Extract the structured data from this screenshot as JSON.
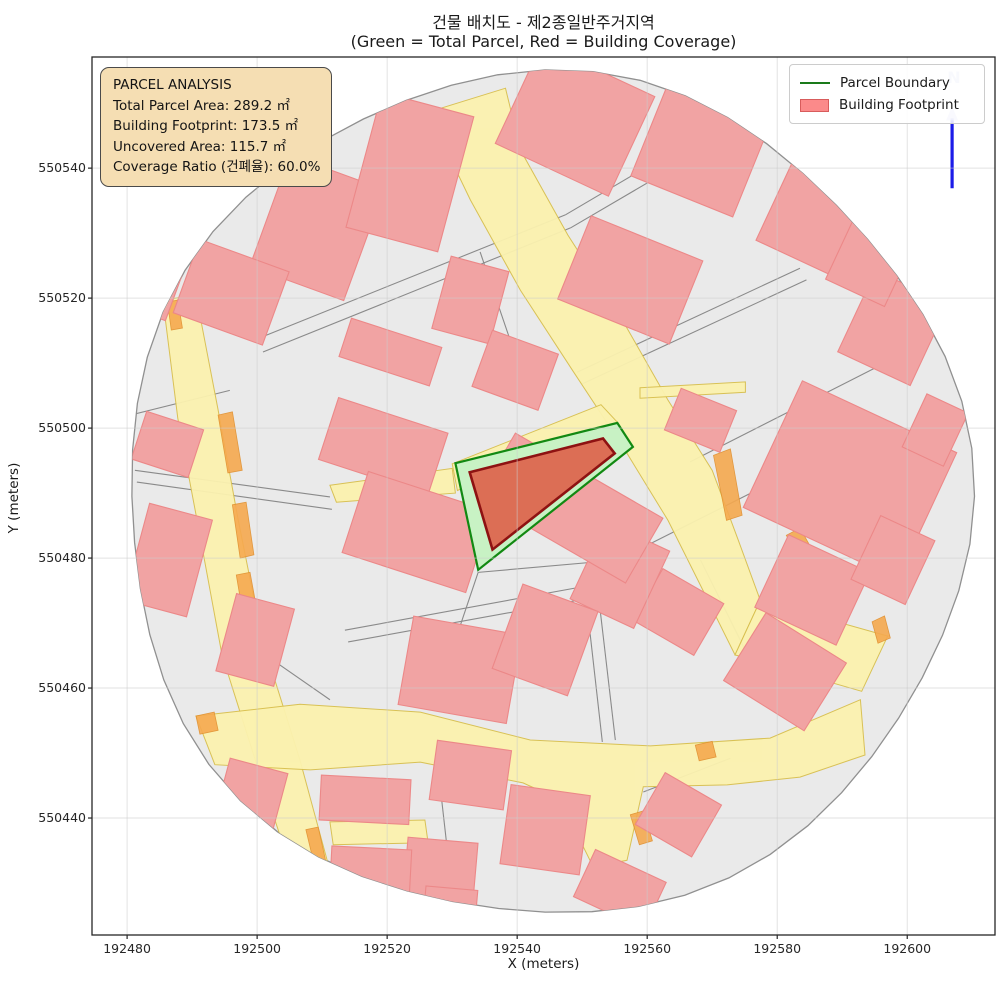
{
  "figure": {
    "title": "건물 배치도 - 제2종일반주거지역",
    "subtitle": "(Green = Total Parcel, Red = Building Coverage)"
  },
  "axes": {
    "xlabel": "X (meters)",
    "ylabel": "Y (meters)",
    "xticks": [
      192480,
      192500,
      192520,
      192540,
      192560,
      192580,
      192600
    ],
    "yticks": [
      550440,
      550460,
      550480,
      550500,
      550520,
      550540
    ],
    "xlim": [
      192474.6,
      192613.5
    ],
    "ylim": [
      550422.0,
      550557.1
    ],
    "grid": true
  },
  "info_box": {
    "lines": [
      "PARCEL ANALYSIS",
      "Total Parcel Area: 289.2 ㎡",
      "Building Footprint: 173.5 ㎡",
      "Uncovered Area: 115.7 ㎡",
      "Coverage Ratio (건폐율): 60.0%"
    ],
    "fill": "#f5deb3"
  },
  "legend": {
    "entries": [
      {
        "label": "Parcel Boundary",
        "type": "line",
        "color": "#1a7a1a"
      },
      {
        "label": "Building Footprint",
        "type": "patch",
        "fill": "#fb8a8a",
        "stroke": "#d85c5c"
      }
    ]
  },
  "north_arrow": {
    "label": "N",
    "shaft_color": "#1c1ce8",
    "head_color": "#b3b9ea",
    "x": 192606.9,
    "y_base": 550536.9,
    "y_tip": 550549.5
  },
  "colors": {
    "buffer_fill": "#eaeaea",
    "buffer_edge": "#909090",
    "road_fill": "#fbf2af",
    "road_edge": "#d8bf4e",
    "orange_fill": "#f5a94f",
    "orange_edge": "#e08f2e",
    "building_fill": "#f1a3a3",
    "building_edge": "#ec8888",
    "parcel_line": "#8a8a8a",
    "parcel_fill": "#c8f2c4",
    "parcel_edge": "#128912",
    "footprint_fill": "#dc6e55",
    "footprint_edge": "#8e1212",
    "grid": "#cccccc",
    "frame": "#262626"
  },
  "chart_data": {
    "type": "map",
    "title": "건물 배치도 - 제2종일반주거지역",
    "buffer": {
      "cx": 192544.3,
      "cy": 550489.5,
      "radius_m": 64.8
    },
    "highlight_parcel": {
      "name": "analysis parcel",
      "points": [
        [
          192530.5,
          550494.6
        ],
        [
          192555.4,
          550500.8
        ],
        [
          192557.8,
          550497.1
        ],
        [
          192534.0,
          550478.2
        ]
      ]
    },
    "highlight_building": {
      "name": "building footprint",
      "points": [
        [
          192532.7,
          550493.2
        ],
        [
          192553.2,
          550498.4
        ],
        [
          192555.0,
          550496.1
        ],
        [
          192536.2,
          550481.3
        ]
      ]
    },
    "roads": [
      [
        [
          192485.5,
          550519.7
        ],
        [
          192490.6,
          550520.5
        ],
        [
          192494.0,
          550502.8
        ],
        [
          192497.1,
          550485.8
        ],
        [
          192500.8,
          550467.4
        ],
        [
          192506.6,
          550448.9
        ],
        [
          192511.5,
          550430.8
        ],
        [
          192506.0,
          550429.8
        ],
        [
          192500.2,
          550447.4
        ],
        [
          192494.6,
          550465.1
        ],
        [
          192491.2,
          550483.5
        ],
        [
          192487.8,
          550501.5
        ]
      ],
      [
        [
          192526.3,
          550548.6
        ],
        [
          192532.8,
          550535.1
        ],
        [
          192540.5,
          550521.2
        ],
        [
          192548.5,
          550508.9
        ],
        [
          192556.6,
          550496.6
        ],
        [
          192563.2,
          550485.8
        ],
        [
          192568.2,
          550475.8
        ],
        [
          192573.5,
          550465.1
        ],
        [
          192577.4,
          550473.5
        ],
        [
          192574.0,
          550482.8
        ],
        [
          192570.0,
          550493.5
        ],
        [
          192563.2,
          550504.3
        ],
        [
          192556.2,
          550516.6
        ],
        [
          192547.8,
          550529.7
        ],
        [
          192540.5,
          550542.8
        ],
        [
          192538.2,
          550552.3
        ]
      ],
      [
        [
          192573.5,
          550465.1
        ],
        [
          192577.4,
          550473.5
        ],
        [
          192597.0,
          550468.0
        ],
        [
          192593.0,
          550459.5
        ]
      ],
      [
        [
          192490.6,
          550455.7
        ],
        [
          192506.6,
          550457.5
        ],
        [
          192525.1,
          550456.3
        ],
        [
          192542.0,
          550452.0
        ],
        [
          192560.5,
          550451.1
        ],
        [
          192578.9,
          550452.3
        ],
        [
          192592.8,
          550458.2
        ],
        [
          192593.5,
          550449.7
        ],
        [
          192583.5,
          550446.3
        ],
        [
          192572.3,
          550445.1
        ],
        [
          192559.4,
          550444.8
        ],
        [
          192556.9,
          550433.5
        ],
        [
          192551.7,
          550432.5
        ],
        [
          192546.6,
          550442.8
        ],
        [
          192540.9,
          550445.4
        ],
        [
          192525.1,
          550448.6
        ],
        [
          192508.2,
          550447.4
        ],
        [
          192493.5,
          550448.2
        ]
      ],
      [
        [
          192511.2,
          550491.2
        ],
        [
          192530.0,
          550493.8
        ],
        [
          192530.5,
          550490.0
        ],
        [
          192512.2,
          550488.6
        ]
      ],
      [
        [
          192530.0,
          550494.5
        ],
        [
          192552.9,
          550503.6
        ],
        [
          192555.4,
          550500.9
        ],
        [
          192530.8,
          550490.4
        ]
      ],
      [
        [
          192558.9,
          550506.2
        ],
        [
          192575.1,
          550507.1
        ],
        [
          192575.1,
          550505.5
        ],
        [
          192558.9,
          550504.6
        ]
      ],
      [
        [
          192511.2,
          550439.4
        ],
        [
          192525.8,
          550439.7
        ],
        [
          192526.3,
          550436.2
        ],
        [
          192511.7,
          550435.9
        ]
      ]
    ],
    "orange_zones": [
      [
        [
          192486.2,
          550519.4
        ],
        [
          192487.8,
          550519.7
        ],
        [
          192488.5,
          550515.4
        ],
        [
          192486.8,
          550515.1
        ]
      ],
      [
        [
          192494.0,
          550502.0
        ],
        [
          192496.2,
          550502.5
        ],
        [
          192497.7,
          550493.5
        ],
        [
          192495.5,
          550493.1
        ]
      ],
      [
        [
          192496.2,
          550488.2
        ],
        [
          192498.3,
          550488.6
        ],
        [
          192499.5,
          550480.5
        ],
        [
          192497.4,
          550480.0
        ]
      ],
      [
        [
          192496.8,
          550477.4
        ],
        [
          192498.9,
          550477.8
        ],
        [
          192500.2,
          550470.8
        ],
        [
          192498.0,
          550470.3
        ]
      ],
      [
        [
          192507.5,
          550438.2
        ],
        [
          192509.4,
          550438.6
        ],
        [
          192510.6,
          550433.2
        ],
        [
          192508.8,
          550432.8
        ]
      ],
      [
        [
          192570.2,
          550495.8
        ],
        [
          192572.8,
          550496.8
        ],
        [
          192574.6,
          550486.6
        ],
        [
          192572.2,
          550485.8
        ]
      ],
      [
        [
          192581.4,
          550483.5
        ],
        [
          192583.5,
          550484.6
        ],
        [
          192588.2,
          550476.3
        ],
        [
          192586.0,
          550475.4
        ]
      ],
      [
        [
          192594.6,
          550470.2
        ],
        [
          192596.5,
          550471.1
        ],
        [
          192597.4,
          550467.7
        ],
        [
          192595.5,
          550466.9
        ]
      ],
      [
        [
          192557.4,
          550440.5
        ],
        [
          192559.4,
          550441.1
        ],
        [
          192560.8,
          550436.5
        ],
        [
          192558.8,
          550435.9
        ]
      ],
      [
        [
          192567.4,
          550451.2
        ],
        [
          192570.0,
          550451.8
        ],
        [
          192570.6,
          550449.4
        ],
        [
          192568.0,
          550448.8
        ]
      ],
      [
        [
          192490.6,
          550455.7
        ],
        [
          192493.4,
          550456.3
        ],
        [
          192494.0,
          550453.5
        ],
        [
          192491.2,
          550452.9
        ]
      ]
    ],
    "buildings": [
      [
        192509.2,
        550530.8,
        15.4,
        18.2,
        -20
      ],
      [
        192496.0,
        550520.9,
        14.6,
        12.0,
        -20
      ],
      [
        192523.5,
        550539.4,
        14.6,
        21.5,
        -15
      ],
      [
        192486.2,
        550497.5,
        9.2,
        7.7,
        -18
      ],
      [
        192486.3,
        550479.7,
        10.0,
        15.4,
        -15
      ],
      [
        192519.4,
        550497.2,
        17.7,
        10.0,
        -18
      ],
      [
        192520.5,
        550511.7,
        14.6,
        6.2,
        -18
      ],
      [
        192524.6,
        550484.0,
        20.0,
        13.1,
        -18
      ],
      [
        192531.2,
        550462.8,
        16.9,
        13.8,
        -10
      ],
      [
        192548.9,
        550547.4,
        19.2,
        16.9,
        -25
      ],
      [
        192568.2,
        550542.8,
        16.9,
        15.4,
        -22
      ],
      [
        192586.6,
        550532.8,
        14.6,
        15.4,
        -25
      ],
      [
        192557.4,
        550522.8,
        18.5,
        13.8,
        -22
      ],
      [
        192591.2,
        550492.0,
        26.2,
        21.5,
        -25
      ],
      [
        192597.8,
        550515.4,
        12.3,
        13.8,
        -25
      ],
      [
        192568.2,
        550501.2,
        9.2,
        6.9,
        -22
      ],
      [
        192585.4,
        550475.1,
        13.8,
        12.3,
        -25
      ],
      [
        192597.8,
        550479.7,
        9.2,
        10.8,
        -25
      ],
      [
        192581.2,
        550462.5,
        14.6,
        12.3,
        -32
      ],
      [
        192564.8,
        550471.7,
        10.8,
        9.2,
        -30
      ],
      [
        192555.8,
        550477.4,
        10.8,
        13.1,
        -25
      ],
      [
        192544.3,
        550467.4,
        12.3,
        13.8,
        -20
      ],
      [
        192548.2,
        550487.7,
        26.2,
        11.5,
        -30
      ],
      [
        192532.8,
        550446.6,
        11.5,
        9.2,
        -8
      ],
      [
        192544.3,
        550438.2,
        12.3,
        12.3,
        -8
      ],
      [
        192528.2,
        550432.0,
        10.8,
        9.2,
        -5
      ],
      [
        192516.6,
        550442.8,
        13.8,
        6.9,
        -3
      ],
      [
        192564.8,
        550440.5,
        10.0,
        9.2,
        -30
      ],
      [
        192499.7,
        550467.4,
        9.2,
        12.3,
        -15
      ],
      [
        192517.4,
        550430.8,
        12.3,
        9.2,
        -3
      ],
      [
        192484.3,
        550521.2,
        6.2,
        7.7,
        -20
      ],
      [
        192532.8,
        550519.7,
        9.2,
        11.5,
        -15
      ],
      [
        192539.7,
        550508.9,
        10.8,
        9.2,
        -20
      ],
      [
        192498.9,
        550442.8,
        9.2,
        10.8,
        -15
      ],
      [
        192529.7,
        550426.2,
        8.0,
        6.0,
        -5
      ],
      [
        192555.8,
        550429.0,
        12.0,
        8.0,
        -25
      ],
      [
        192604.3,
        550499.7,
        7.0,
        9.0,
        -25
      ],
      [
        192594.3,
        550525.8,
        10.0,
        11.0,
        -25
      ]
    ],
    "parcel_lines": [
      [
        192500.2,
        550513.8,
        192547.4,
        550532.8
      ],
      [
        192500.9,
        550511.7,
        192548.2,
        550530.8
      ],
      [
        192547.4,
        550532.8,
        192577.4,
        550550.5
      ],
      [
        192548.2,
        550530.8,
        192578.6,
        550548.6
      ],
      [
        192481.2,
        550493.5,
        192511.2,
        550489.4
      ],
      [
        192481.5,
        550491.7,
        192511.5,
        550487.5
      ],
      [
        192513.5,
        550468.9,
        192551.2,
        550475.8
      ],
      [
        192514.0,
        550467.1,
        192551.5,
        550473.9
      ],
      [
        192549.2,
        550508.6,
        192583.5,
        550524.6
      ],
      [
        192550.0,
        550506.8,
        192584.5,
        550522.8
      ],
      [
        192566.6,
        550494.8,
        192598.9,
        550511.2
      ],
      [
        192555.5,
        550479.7,
        192583.5,
        550493.8
      ],
      [
        192550.9,
        550471.2,
        192553.1,
        550451.7
      ],
      [
        192552.8,
        550471.7,
        192555.1,
        550452.0
      ],
      [
        192527.7,
        550448.9,
        192530.0,
        550428.5
      ],
      [
        192559.4,
        550444.0,
        192572.8,
        550449.2
      ],
      [
        192589.4,
        550528.6,
        192606.9,
        550516.3
      ],
      [
        192495.8,
        550468.9,
        192511.2,
        550458.2
      ],
      [
        192534.3,
        550527.1,
        192540.5,
        550508.9
      ],
      [
        192568.2,
        550479.7,
        192575.1,
        550465.8
      ],
      [
        192480.5,
        550502.0,
        192495.8,
        550505.8
      ],
      [
        192534.0,
        550477.8,
        192555.5,
        550479.7
      ],
      [
        192534.0,
        550477.8,
        192530.5,
        550467.4
      ]
    ]
  }
}
